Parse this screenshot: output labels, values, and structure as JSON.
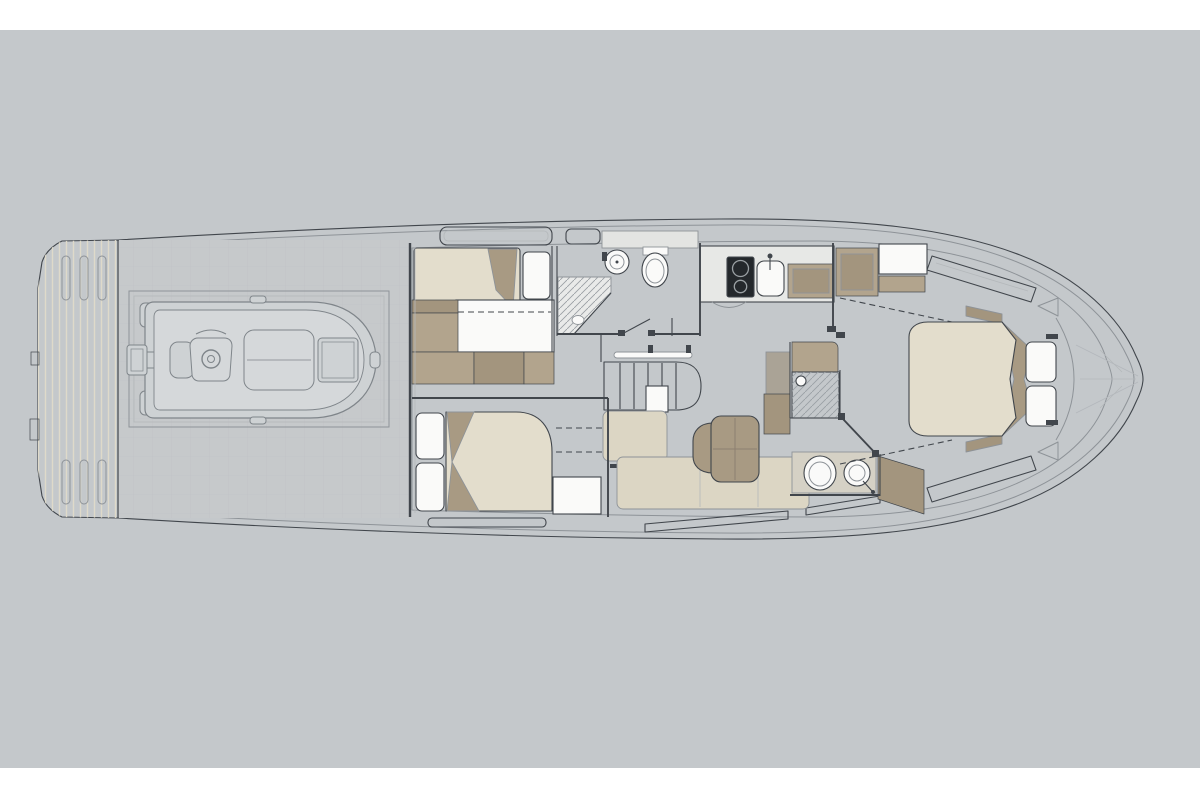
{
  "figure": {
    "kind": "yacht-lower-deck-floor-plan",
    "orientation": "bow-right",
    "canvas": {
      "width": 1200,
      "height": 800,
      "artwork_top": 30,
      "artwork_bottom": 768
    }
  },
  "colors": {
    "page": "#ffffff",
    "canvas": "#c4c8cb",
    "hullFill": "#fbfcfb",
    "interiorFloor": "#f2f3f1",
    "deck": "#c6c9cb",
    "garage": "#cbcfd1",
    "tenderFill": "#ced2d4",
    "tenderInner": "#d5d8da",
    "platform": "#ece8da",
    "platformStripe": "#dfdaca",
    "slot": "#f7f6f1",
    "mattress": "#e3ddcc",
    "sofa": "#dcd6c4",
    "tan": "#b2a48d",
    "tanDark": "#a3957e",
    "accentTan": "#a89a83",
    "counter": "#e7e8e6",
    "cooktop": "#24282c",
    "fixture": "#fafaf9",
    "wcFloor": "#d5d1c5",
    "grayColumn": "#aaa396",
    "windowFill": "#fdfdfc",
    "bandGray": "#e3e4e2",
    "line": "#41464c",
    "lineMid": "#8e9398",
    "lineLight": "#b4b8bb"
  },
  "areas": [
    {
      "id": "swim-platform"
    },
    {
      "id": "aft-deck-tender-garage"
    },
    {
      "id": "tender"
    },
    {
      "id": "twin-guest-cabin"
    },
    {
      "id": "vip-guest-cabin"
    },
    {
      "id": "guest-bathroom"
    },
    {
      "id": "companionway-stairs"
    },
    {
      "id": "salon-dinette"
    },
    {
      "id": "galley"
    },
    {
      "id": "master-bathroom"
    },
    {
      "id": "master-cabin"
    },
    {
      "id": "bow-locker"
    }
  ]
}
